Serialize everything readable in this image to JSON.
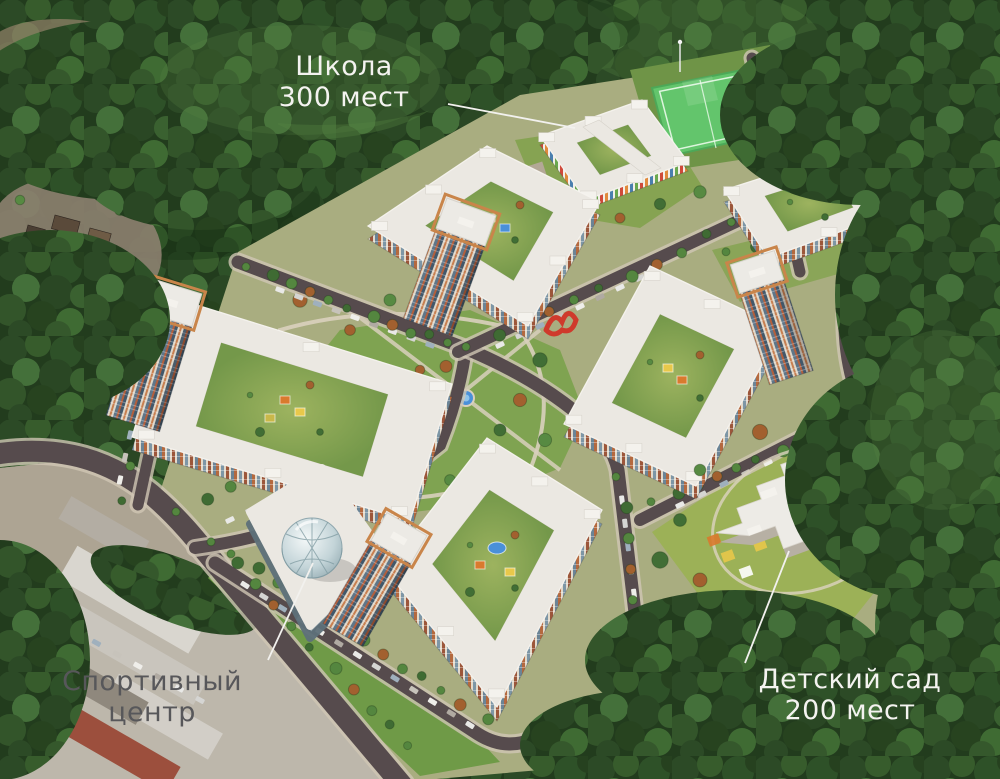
{
  "scene": {
    "description": "Aerial 3D render of a residential development masterplan surrounded by forest",
    "annotations": {
      "school": {
        "line1": "Школа",
        "line2": "300 мест"
      },
      "sports_center": {
        "line1": "Спортивный",
        "line2": "центр"
      },
      "kindergarten": {
        "line1": "Детский сад",
        "line2": "200 мест"
      }
    },
    "colors": {
      "label_light": "#f4f3f0",
      "label_dark": "#57575a",
      "leader": "#f2f1ee",
      "forest": "#223c1d",
      "road": "#564b4d",
      "road_edge": "#cfc6b4",
      "roof": "#ebe8e2",
      "facade_terracotta": "#b4693f",
      "facade_blue": "#7d96a6",
      "lawn": "#7ca24e",
      "sports_field": "#63c56c",
      "water": "#4a90d9",
      "path": "#d9d0bd",
      "crown": "#c9854a",
      "sculpture": "#cf3a2c"
    }
  }
}
